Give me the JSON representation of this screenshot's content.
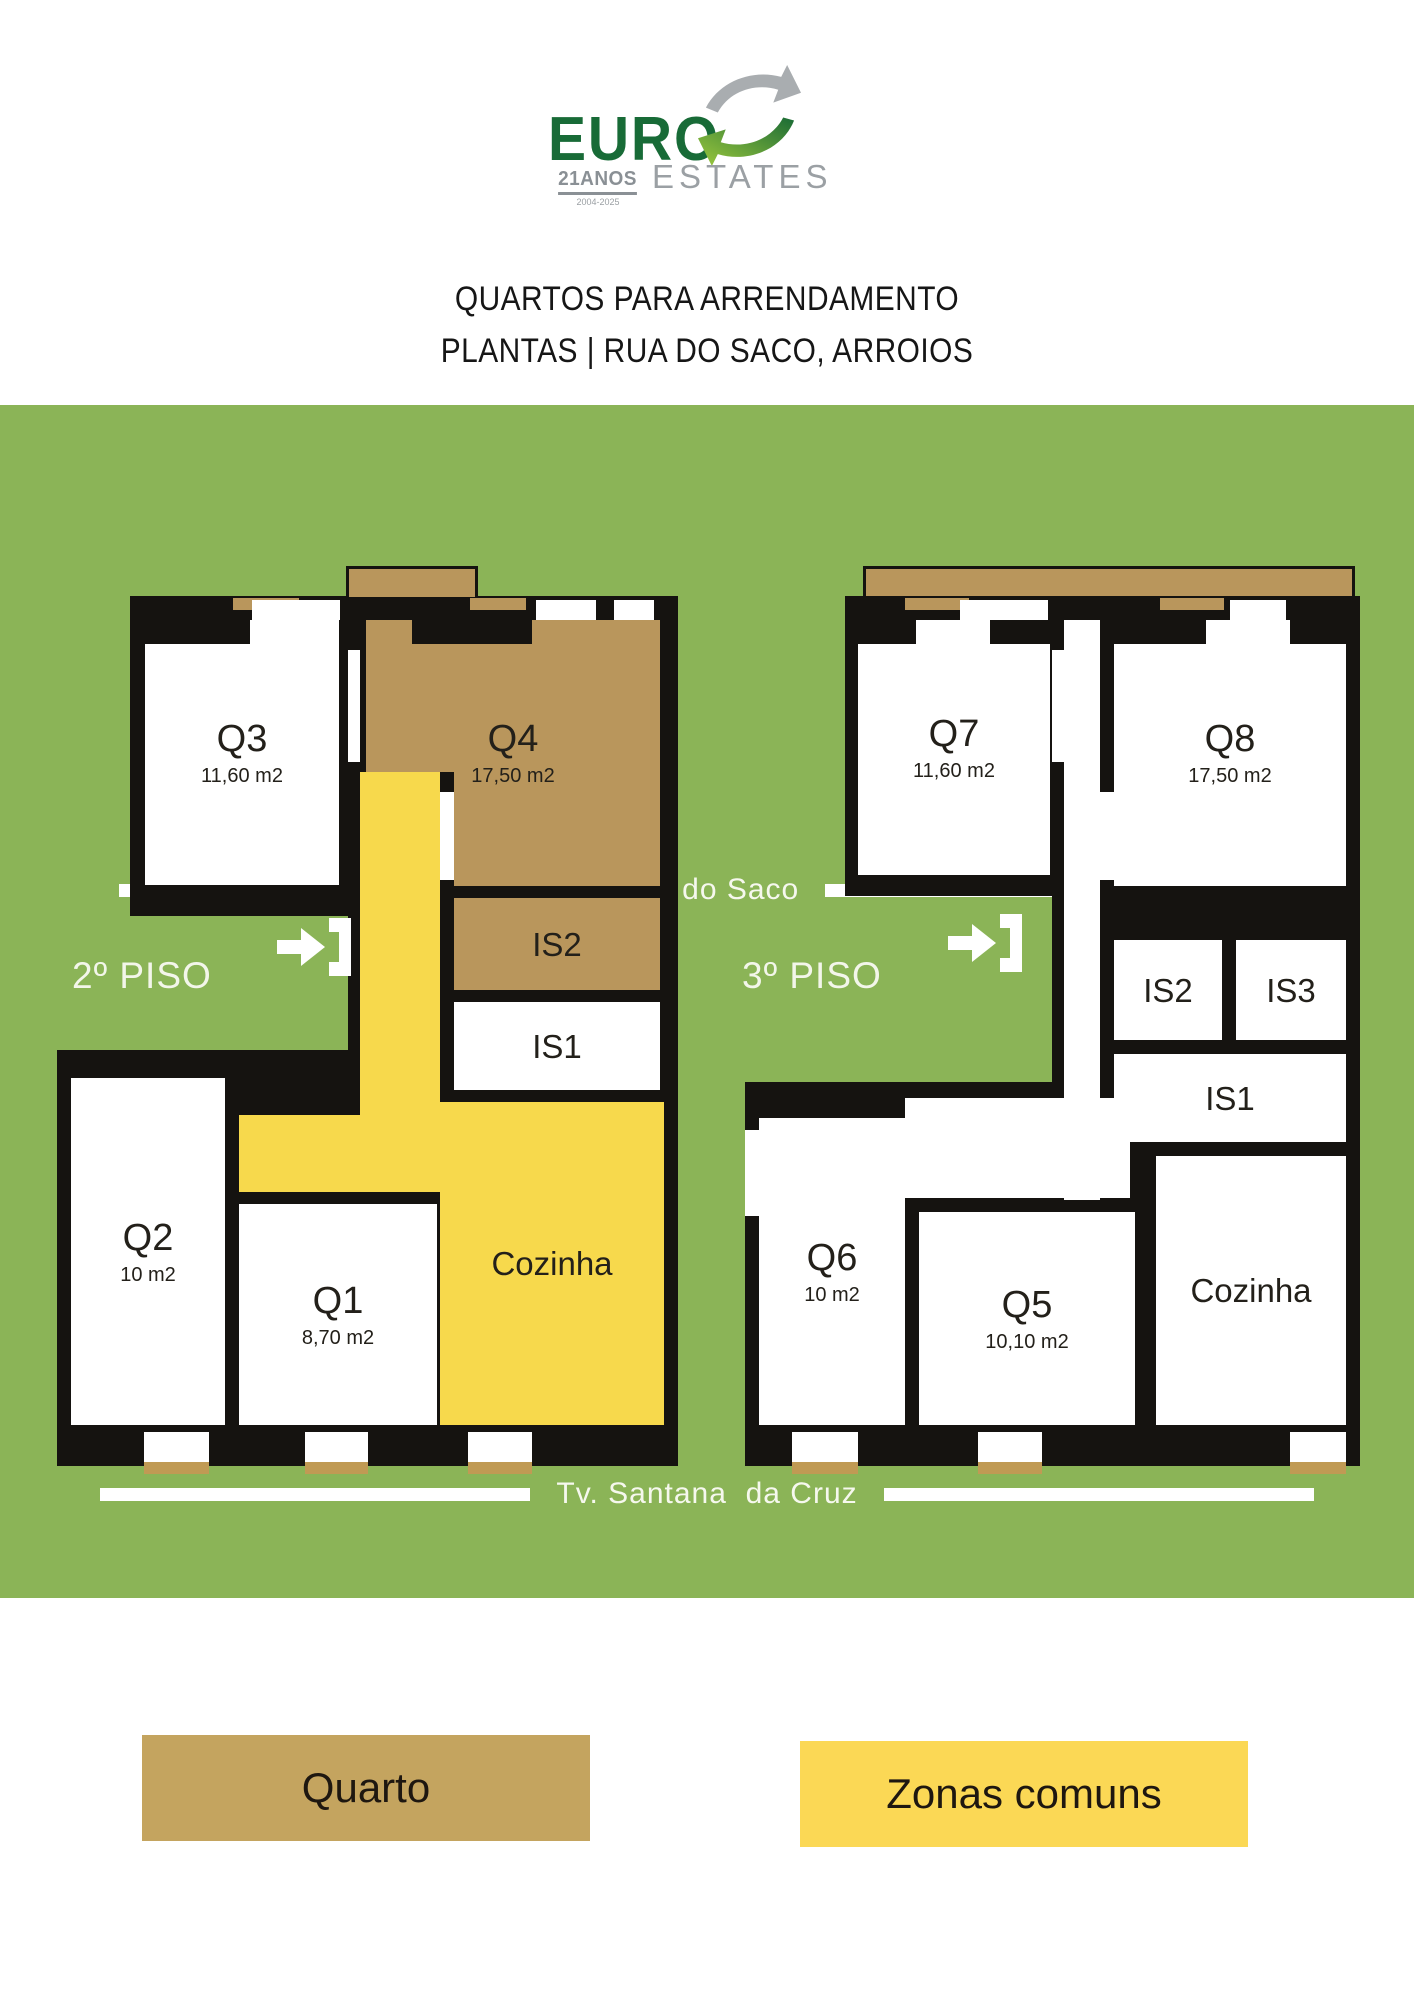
{
  "logo": {
    "brand": "EURO",
    "anos": "21ANOS",
    "years": "2004-2025",
    "sub": "ESTATES"
  },
  "title": {
    "line1": "QUARTOS PARA ARRENDAMENTO",
    "line2": "PLANTAS | RUA DO SACO, ARROIOS"
  },
  "streets": {
    "top": "Rua do Saco",
    "bottom": "Tv. Santana  da Cruz"
  },
  "floors": [
    {
      "label": "2º PISO",
      "rooms": {
        "q3": {
          "name": "Q3",
          "area": "11,60 m2"
        },
        "q4": {
          "name": "Q4",
          "area": "17,50 m2"
        },
        "is2": {
          "name": "IS2"
        },
        "is1": {
          "name": "IS1"
        },
        "cozinha": {
          "name": "Cozinha"
        },
        "q2": {
          "name": "Q2",
          "area": "10 m2"
        },
        "q1": {
          "name": "Q1",
          "area": "8,70 m2"
        }
      }
    },
    {
      "label": "3º PISO",
      "rooms": {
        "q7": {
          "name": "Q7",
          "area": "11,60 m2"
        },
        "q8": {
          "name": "Q8",
          "area": "17,50 m2"
        },
        "is2": {
          "name": "IS2"
        },
        "is3": {
          "name": "IS3"
        },
        "is1": {
          "name": "IS1"
        },
        "cozinha": {
          "name": "Cozinha"
        },
        "q6": {
          "name": "Q6",
          "area": "10 m2"
        },
        "q5": {
          "name": "Q5",
          "area": "10,10 m2"
        }
      }
    }
  ],
  "legend": {
    "quarto": "Quarto",
    "zonas": "Zonas comuns"
  },
  "colors": {
    "background_green": "#8BB457",
    "quarto_tan": "#B9965C",
    "quarto_legend_tan": "#C4A45F",
    "zonas_yellow": "#F7D94C",
    "zonas_legend_yellow": "#FBD855",
    "wall_black": "#151310",
    "logo_green": "#186B37",
    "logo_gray": "#9BA0A4"
  }
}
